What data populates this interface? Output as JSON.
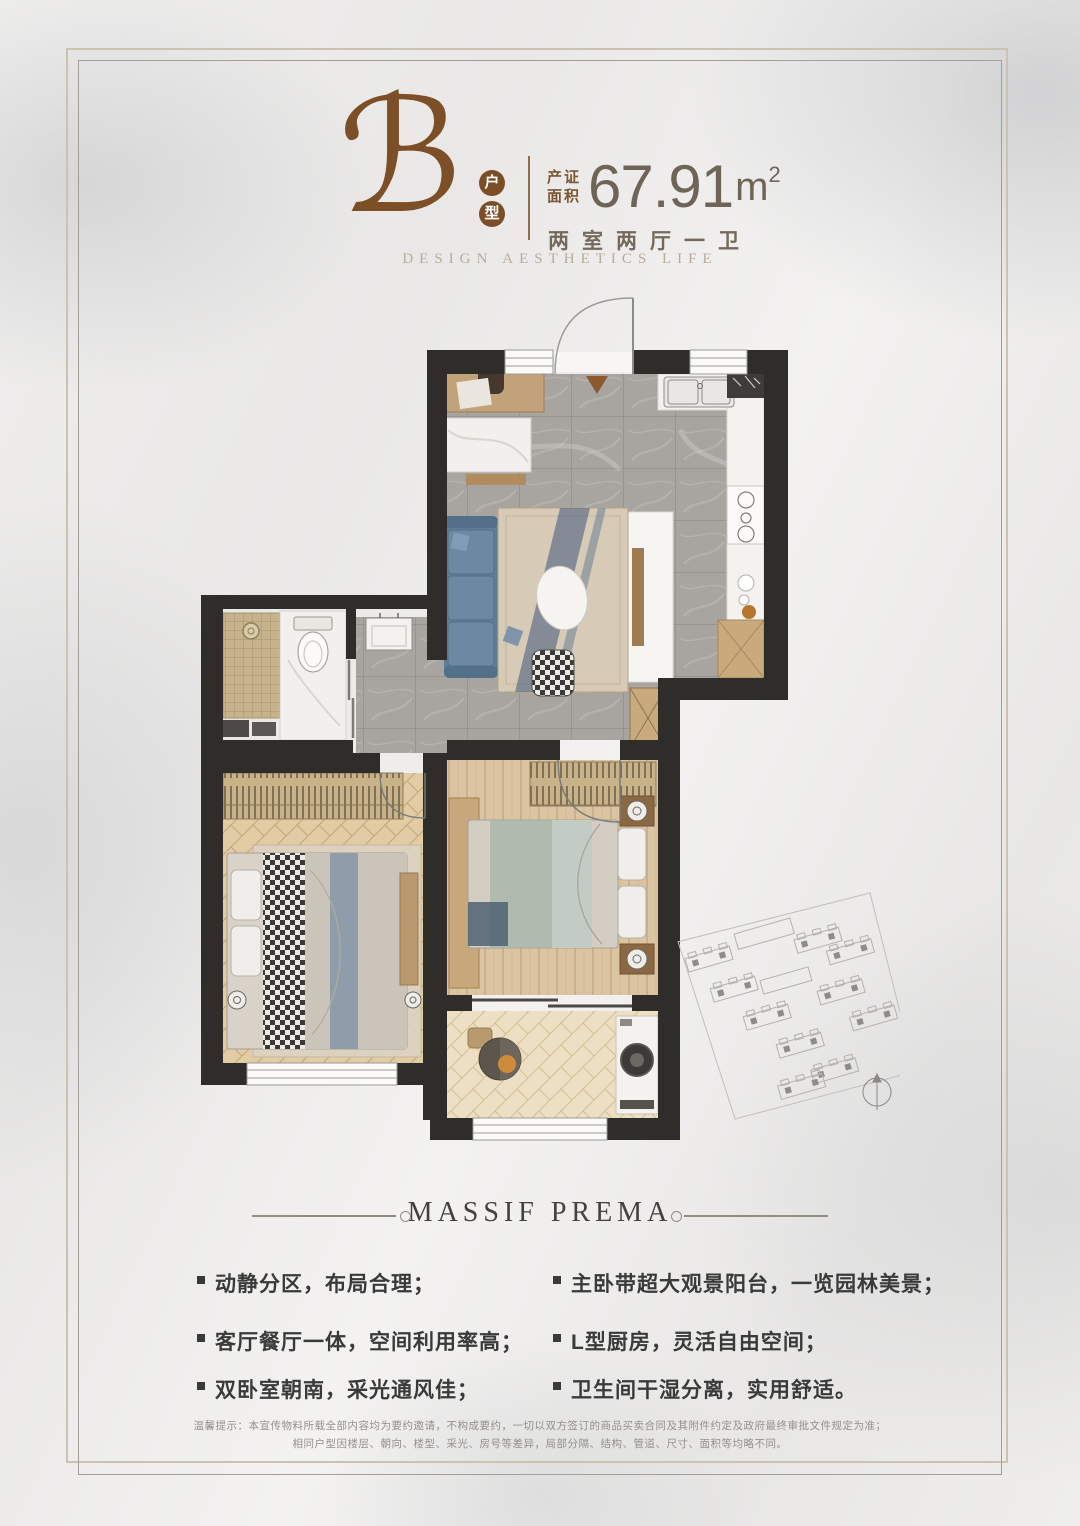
{
  "colors": {
    "accent_brown": "#7b4e28",
    "wall_dark": "#2f2d2a",
    "title_gray": "#45413d",
    "marble_bg": "#edeceb"
  },
  "header": {
    "unit_letter": "ℬ",
    "unit_badge": [
      "户",
      "型"
    ],
    "area_label": [
      "产证",
      "面积"
    ],
    "area_value": "67.91",
    "area_unit": "m",
    "area_sup": "2",
    "layout_text": "两室两厅一卫",
    "tagline": "DESIGN AESTHETICS LIFE"
  },
  "section": {
    "title": "MASSIF PREMA"
  },
  "features": {
    "left": [
      "动静分区，布局合理；",
      "客厅餐厅一体，空间利用率高；",
      "双卧室朝南，采光通风佳；"
    ],
    "right": [
      "主卧带超大观景阳台，一览园林美景；",
      "L型厨房，灵活自由空间；",
      "卫生间干湿分离，实用舒适。"
    ]
  },
  "disclaimer": [
    "温馨提示：本宣传物料所载全部内容均为要约邀请，不构成要约，一切以双方签订的商品买卖合同及其附件约定及政府最终审批文件规定为准；",
    "相同户型因楼层、朝向、楼型、采光、房号等差异，局部分隔、结构、管道、尺寸、面积等均略不同。"
  ]
}
